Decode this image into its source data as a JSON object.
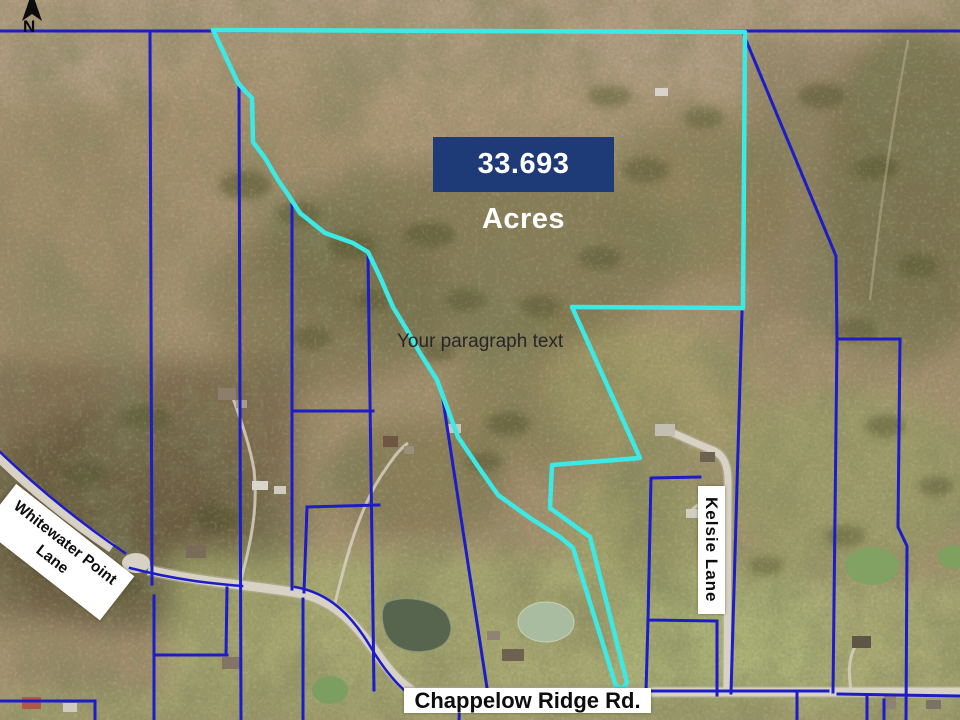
{
  "compass": {
    "label": "N"
  },
  "overlay": {
    "acreage": "33.693 Acres",
    "placeholder": "Your paragraph text"
  },
  "roads": {
    "whitewater_line1": "Whitewater Point",
    "whitewater_line2": "Lane",
    "kelsie": "Kelsie Lane",
    "chappelow": "Chappelow Ridge Rd."
  },
  "colors": {
    "boundary_cyan": "#3de9e4",
    "parcel_blue": "#1c1cc8",
    "acreage_bg": "#1e3a77",
    "acreage_text": "#ffffff",
    "road_label_bg": "#ffffff",
    "road_label_text": "#0d0d0d"
  }
}
